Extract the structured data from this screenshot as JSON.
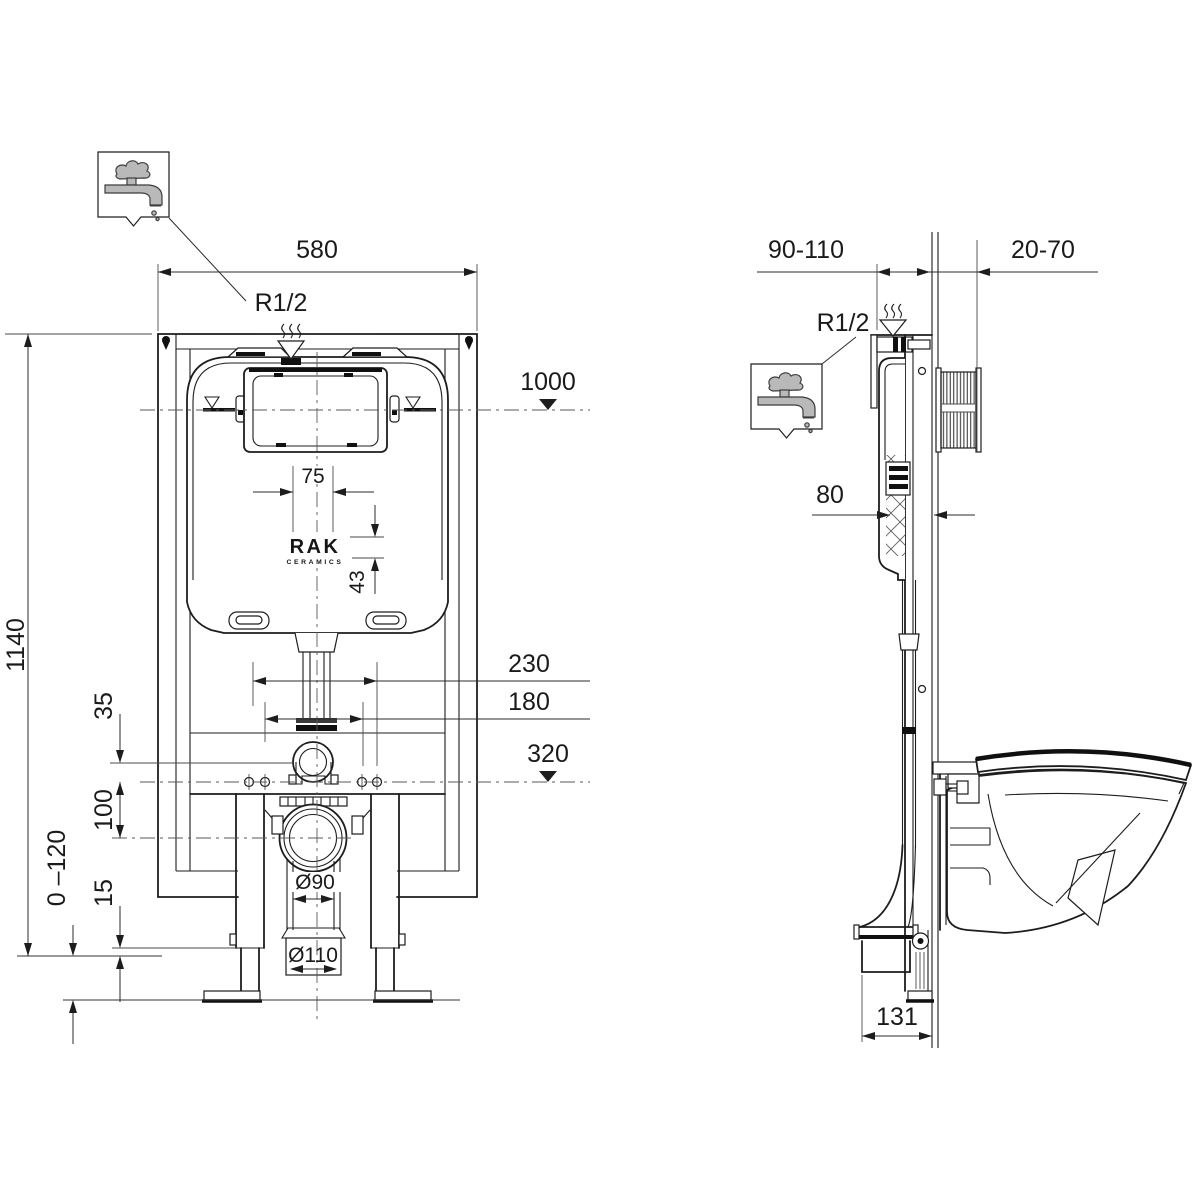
{
  "drawing": {
    "brand": {
      "name": "RAK",
      "sub": "CERAMICS"
    },
    "front_view": {
      "width": "580",
      "inlet_thread": "R1/2",
      "upper_level": "1000",
      "access_offset": "75",
      "logo_offset": "43",
      "spacing_outer": "230",
      "spacing_inner": "180",
      "lower_level": "320",
      "bend_offset": "35",
      "drain_offset": "100",
      "foot_clearance": "15",
      "adjust_range": "0 –120",
      "frame_height": "1140",
      "drain_diameter": "Ø90",
      "outlet_diameter": "Ø110"
    },
    "side_view": {
      "wall_range": "90-110",
      "finish_range": "20-70",
      "inlet_thread": "R1/2",
      "tank_depth": "80",
      "outlet_offset": "131"
    },
    "icons": {
      "water_supply": "water-tap"
    }
  }
}
